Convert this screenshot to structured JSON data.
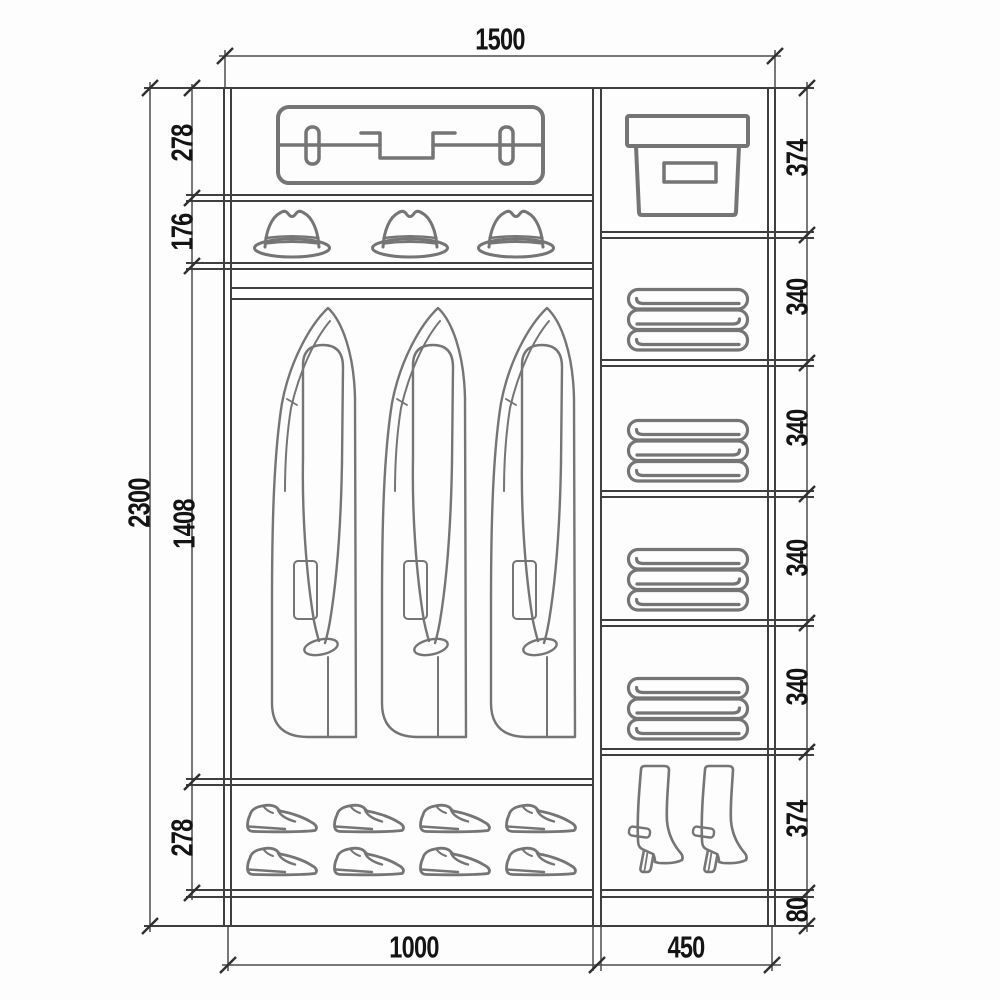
{
  "diagram": {
    "kind": "wardrobe-interior-elevation",
    "dims": {
      "width_total": "1500",
      "height_total": "2300",
      "left_col_width": "1000",
      "right_col_width": "450",
      "left_sections": [
        {
          "label": "278",
          "item": "suitcase-shelf"
        },
        {
          "label": "176",
          "item": "hat-shelf"
        },
        {
          "label": "1408",
          "item": "hanging-rail-coats"
        },
        {
          "label": "278",
          "item": "shoe-shelf"
        }
      ],
      "right_sections": [
        {
          "label": "374",
          "item": "storage-box-shelf"
        },
        {
          "label": "340",
          "item": "folded-linen-shelf"
        },
        {
          "label": "340",
          "item": "folded-linen-shelf"
        },
        {
          "label": "340",
          "item": "folded-linen-shelf"
        },
        {
          "label": "340",
          "item": "folded-linen-shelf"
        },
        {
          "label": "374",
          "item": "boots-compartment"
        },
        {
          "label": "80",
          "item": "plinth"
        }
      ]
    },
    "colors": {
      "structure_line": "#3f3f3f",
      "dimension_line": "#4c4c4c",
      "icon_line": "#757575",
      "text": "#141414",
      "background": "#fdfdfd"
    }
  }
}
